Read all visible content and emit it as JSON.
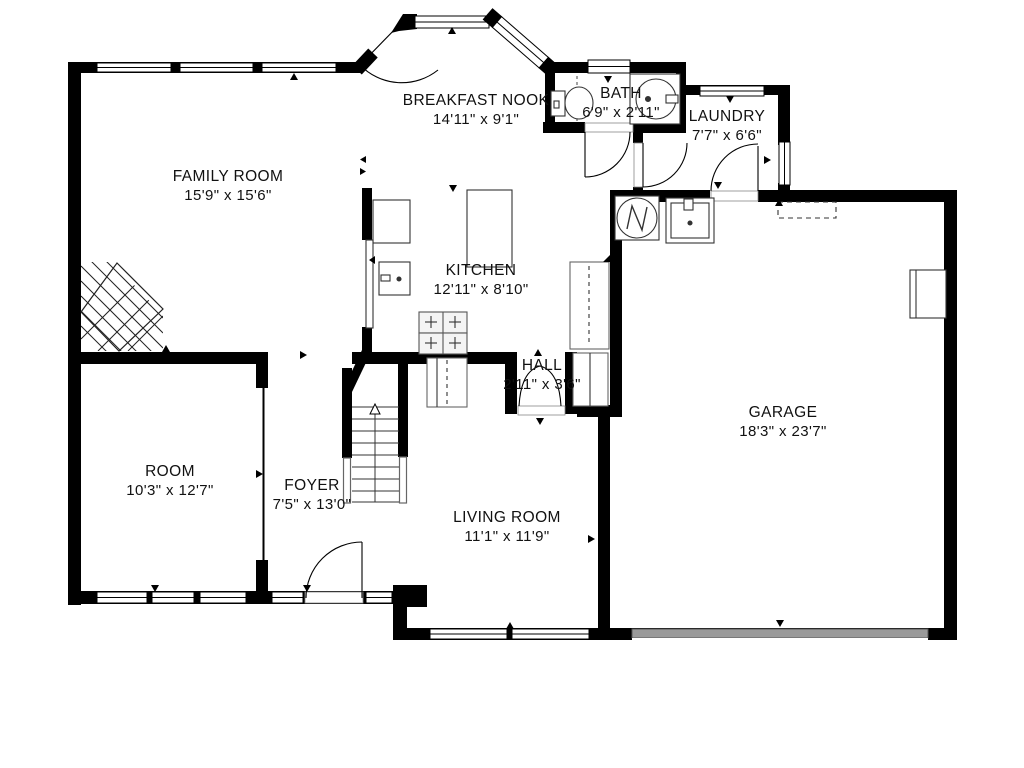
{
  "plan": {
    "title": "Floor Plan",
    "rooms": [
      {
        "id": "family-room",
        "name": "FAMILY ROOM",
        "dims": "15'9\" x 15'6\""
      },
      {
        "id": "breakfast-nook",
        "name": "BREAKFAST NOOK",
        "dims": "14'11\" x 9'1\""
      },
      {
        "id": "bath",
        "name": "BATH",
        "dims": "6'9\" x 2'11\""
      },
      {
        "id": "laundry",
        "name": "LAUNDRY",
        "dims": "7'7\" x 6'6\""
      },
      {
        "id": "kitchen",
        "name": "KITCHEN",
        "dims": "12'11\" x 8'10\""
      },
      {
        "id": "hall",
        "name": "HALL",
        "dims": "2'11\" x 3'6\""
      },
      {
        "id": "garage",
        "name": "GARAGE",
        "dims": "18'3\" x 23'7\""
      },
      {
        "id": "room",
        "name": "ROOM",
        "dims": "10'3\" x 12'7\""
      },
      {
        "id": "foyer",
        "name": "FOYER",
        "dims": "7'5\" x 13'0\""
      },
      {
        "id": "living-room",
        "name": "LIVING ROOM",
        "dims": "11'1\" x 11'9\""
      }
    ],
    "fixtures": [
      "corner-fireplace",
      "staircase-up",
      "range-cooktop",
      "wall-oven",
      "refrigerator-counter",
      "kitchen-island",
      "pantry",
      "hall-closet",
      "stair-closet",
      "toilet",
      "bathroom-vanity-sink",
      "water-heater",
      "utility-sink",
      "attic-access-dashed",
      "garage-door",
      "garage-side-window",
      "front-door",
      "bay-window"
    ],
    "colors": {
      "wall": "#000000",
      "background": "#ffffff",
      "garage_door": "#9a9a9a",
      "stair_lower_wall": "#cfcfcf",
      "counter_outline": "#444444"
    }
  }
}
